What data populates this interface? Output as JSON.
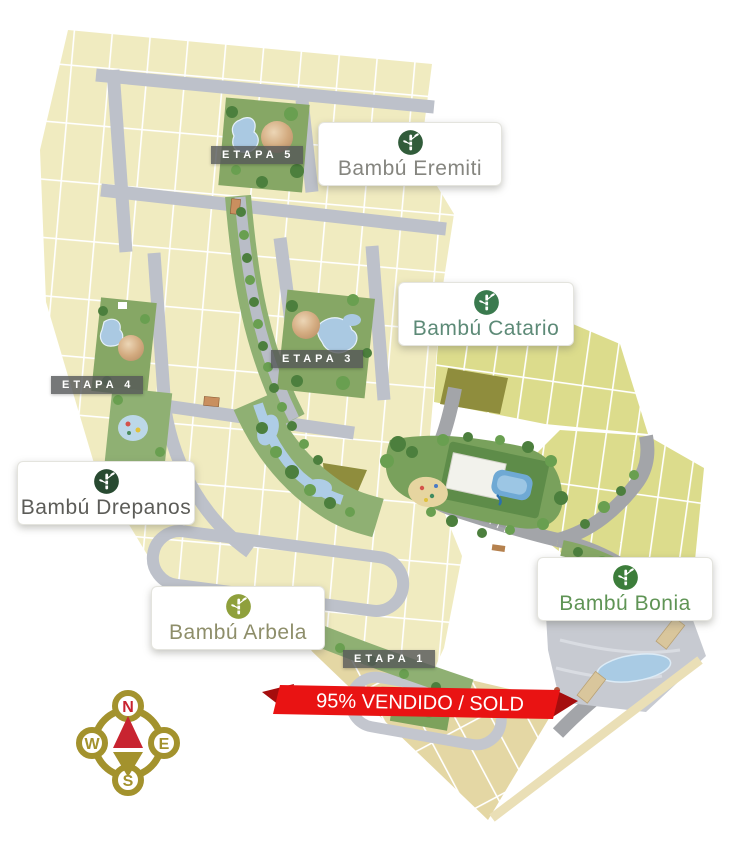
{
  "banner": {
    "text": "95% VENDIDO / SOLD",
    "color": "#e91313"
  },
  "phases": [
    {
      "label": "ETAPA 5"
    },
    {
      "label": "ETAPA 4"
    },
    {
      "label": "ETAPA 3"
    },
    {
      "label": "ETAPA 1"
    }
  ],
  "labels": {
    "eremiti": {
      "name": "Bambú Eremiti"
    },
    "catario": {
      "name": "Bambú Catario"
    },
    "drepanos": {
      "name": "Bambú Drepanos"
    },
    "arbela": {
      "name": "Bambú Arbela"
    },
    "bonia": {
      "name": "Bambú Bonia"
    }
  },
  "compass": {
    "north": "N",
    "east": "E",
    "south": "S",
    "west": "W"
  },
  "colors": {
    "accent_red": "#e91313",
    "compass_gold": "#a3922d",
    "brand_green": "#3a7a4e",
    "lot_beige": "#f0ebc0",
    "lot_yellow_green": "#dcdc8c",
    "road_gray": "#bdc1ca"
  }
}
